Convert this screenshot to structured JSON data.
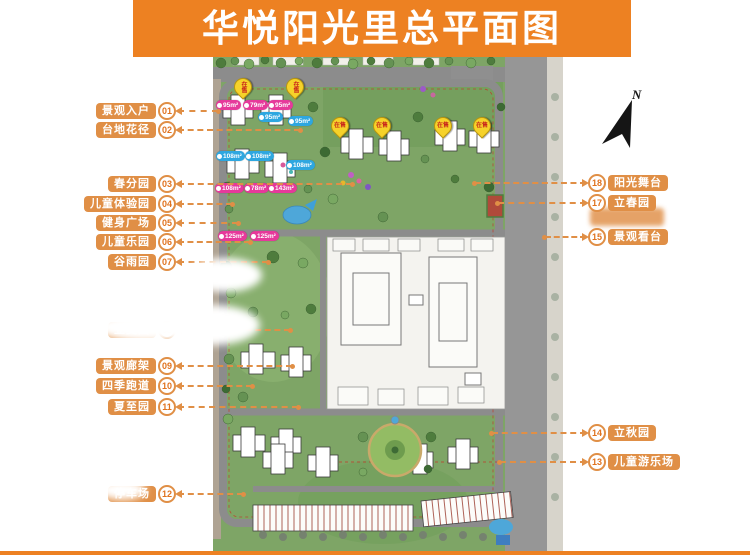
{
  "title": "华悦阳光里总平面图",
  "compass": {
    "label": "N"
  },
  "colors": {
    "title_bar": "#ED8122",
    "label_box": "#E08F46",
    "tag_pink": "#E6399B",
    "tag_blue": "#2EA7E0",
    "pin_yellow": "#F6D22A",
    "pin_text_red": "#C8261B"
  },
  "left_labels": [
    {
      "number": "01",
      "text": "景观入户"
    },
    {
      "number": "02",
      "text": "台地花径"
    },
    {
      "number": "03",
      "text": "春分园"
    },
    {
      "number": "04",
      "text": "儿童体验园"
    },
    {
      "number": "05",
      "text": "健身广场"
    },
    {
      "number": "06",
      "text": "儿童乐园"
    },
    {
      "number": "07",
      "text": "谷雨园"
    },
    {
      "number": "08",
      "text": "立夏园"
    },
    {
      "number": "09",
      "text": "景观廊架"
    },
    {
      "number": "10",
      "text": "四季跑道"
    },
    {
      "number": "11",
      "text": "夏至园"
    },
    {
      "number": "12",
      "text": "停车场"
    }
  ],
  "right_labels": [
    {
      "number": "18",
      "text": "阳光舞台"
    },
    {
      "number": "17",
      "text": "立春园"
    },
    {
      "number": "15",
      "text": "景观看台"
    },
    {
      "number": "14",
      "text": "立秋园"
    },
    {
      "number": "13",
      "text": "儿童游乐场"
    }
  ],
  "area_tags": [
    {
      "text": "95m²",
      "color": "pink"
    },
    {
      "text": "79m²",
      "color": "pink"
    },
    {
      "text": "95m²",
      "color": "pink"
    },
    {
      "text": "95m²",
      "color": "blue"
    },
    {
      "text": "95m²",
      "color": "blue"
    },
    {
      "text": "108m²",
      "color": "blue"
    },
    {
      "text": "108m²",
      "color": "blue"
    },
    {
      "text": "108m²",
      "color": "blue"
    },
    {
      "text": "108m²",
      "color": "pink"
    },
    {
      "text": "78m²",
      "color": "pink"
    },
    {
      "text": "143m²",
      "color": "pink"
    },
    {
      "text": "125m²",
      "color": "pink"
    },
    {
      "text": "125m²",
      "color": "pink"
    }
  ],
  "sale_pins": [
    {
      "text": "在售"
    },
    {
      "text": "在售"
    },
    {
      "text": "在售"
    },
    {
      "text": "在售"
    },
    {
      "text": "在售"
    },
    {
      "text": "在售"
    }
  ]
}
